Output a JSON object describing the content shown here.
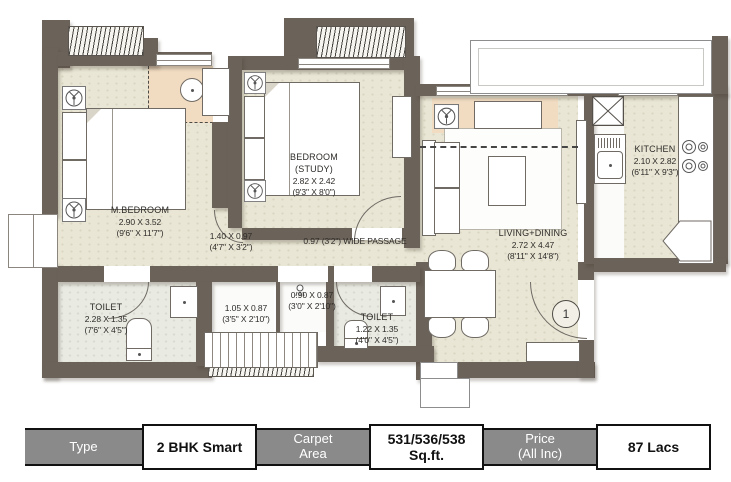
{
  "plan": {
    "rooms": {
      "m_bedroom": {
        "name": "M.BEDROOM",
        "dim_m": "2.90 X 3.52",
        "dim_ft": "(9'6\" X 11'7\")"
      },
      "bedroom_study": {
        "name": "BEDROOM",
        "name2": "(STUDY)",
        "dim_m": "2.82 X 2.42",
        "dim_ft": "(9'3\" X 8'0\")"
      },
      "foyer": {
        "dim_m": "1.40 X 0.97",
        "dim_ft": "(4'7\" X 3'2\")"
      },
      "passage": {
        "label": "0.97 (3'2\") WIDE PASSAGE"
      },
      "living_dining": {
        "name": "LIVING+DINING",
        "dim_m": "2.72 X 4.47",
        "dim_ft": "(8'11\" X 14'8\")"
      },
      "kitchen": {
        "name": "KITCHEN",
        "dim_m": "2.10 X 2.82",
        "dim_ft": "(6'11\" X 9'3\")"
      },
      "toilet_1": {
        "name": "TOILET",
        "dim_m": "2.28 X 1.35",
        "dim_ft": "(7'6\" X 4'5\")"
      },
      "dresser": {
        "dim_m": "1.05 X 0.87",
        "dim_ft": "(3'5\" X 2'10\")"
      },
      "shower_lobby": {
        "dim_m": "0.90 X 0.87",
        "dim_ft": "(3'0\" X 2'10\")"
      },
      "toilet_2": {
        "name": "TOILET",
        "dim_m": "1.22 X 1.35",
        "dim_ft": "(4'0\" X 4'5\")"
      }
    },
    "entrance_marker": "1"
  },
  "info_table": {
    "cells": [
      {
        "kind": "header",
        "text": "Type"
      },
      {
        "kind": "value",
        "text": "2 BHK Smart"
      },
      {
        "kind": "header",
        "text": "Carpet\nArea"
      },
      {
        "kind": "value",
        "text": "531/536/538 Sq.ft."
      },
      {
        "kind": "header",
        "text": "Price\n(All Inc)"
      },
      {
        "kind": "value",
        "text": "87 Lacs"
      }
    ]
  },
  "colors": {
    "wall": "#6b6259",
    "floor": "#e9e6d5",
    "toilet_floor": "#e9eae2",
    "accent_tan": "#f1dcc2",
    "table_header_bg": "#8a8a8a",
    "table_header_text": "#ffffff",
    "table_value_text": "#111111"
  }
}
